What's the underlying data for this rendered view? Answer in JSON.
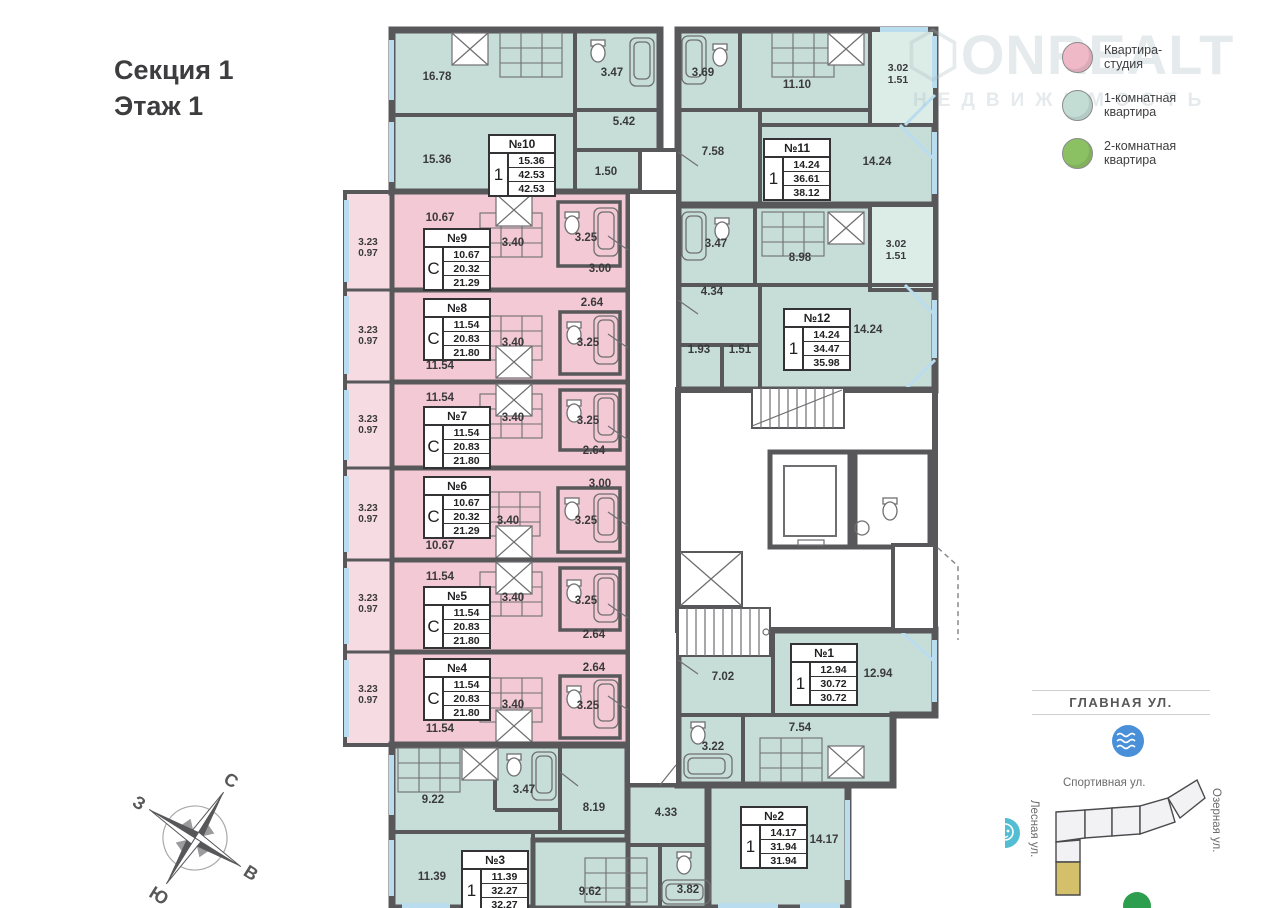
{
  "header": {
    "section": "Секция 1",
    "floor": "Этаж 1"
  },
  "watermark": {
    "brand": "ONREALT",
    "sub": "НЕДВИЖИМОСТЬ"
  },
  "legend": {
    "items": [
      {
        "label": "Квартира-студия",
        "color": "#efb9c8"
      },
      {
        "label": "1-комнатная квартира",
        "color": "#c3ddd5"
      },
      {
        "label": "2-комнатная квартира",
        "color": "#8cc163"
      }
    ]
  },
  "compass": {
    "north": "С",
    "south": "Ю",
    "west": "З",
    "east": "В"
  },
  "minimap": {
    "main_street": "ГЛАВНАЯ УЛ.",
    "sport_street": "Спортивная ул.",
    "lake_street": "Озерная ул.",
    "forest_street": "Лесная ул."
  },
  "colors": {
    "studio_fill": "#f2c9d4",
    "one_room_fill": "#c7ded8",
    "walls": "#58585a",
    "balcony_pink": "#f6dbe2",
    "balcony_teal": "#dcece7",
    "window": "#b9dcee",
    "minimap_section": "#d4c06b",
    "pool_icon": "#4a90d8",
    "kindergarten_icon": "#53bdd3",
    "park_icon": "#2d9e4e"
  },
  "apartments": {
    "a1": {
      "no": "№1",
      "type": "1",
      "living": "12.94",
      "area": "30.72",
      "total": "30.72",
      "rooms": {
        "hall": "7.02",
        "room": "12.94",
        "bath": "3.22",
        "kitchen": "7.54"
      }
    },
    "a2": {
      "no": "№2",
      "type": "1",
      "living": "14.17",
      "area": "31.94",
      "total": "31.94",
      "rooms": {
        "hall": "4.33",
        "room": "14.17",
        "kitchen": "9.62",
        "bath": "3.82"
      }
    },
    "a3": {
      "no": "№3",
      "type": "1",
      "living": "11.39",
      "area": "32.27",
      "total": "32.27",
      "rooms": {
        "r1": "9.22",
        "bath": "3.47",
        "hall": "8.19",
        "room": "11.39"
      }
    },
    "a4": {
      "no": "№4",
      "type": "С",
      "living": "11.54",
      "area": "20.83",
      "total": "21.80",
      "rooms": {
        "main": "11.54",
        "kitchen": "3.40",
        "bath": "3.25",
        "hall": "2.64"
      },
      "balcony": {
        "a": "3.23",
        "b": "0.97"
      }
    },
    "a5": {
      "no": "№5",
      "type": "С",
      "living": "11.54",
      "area": "20.83",
      "total": "21.80",
      "rooms": {
        "main": "11.54",
        "kitchen": "3.40",
        "bath": "3.25",
        "hall": "2.64"
      },
      "balcony": {
        "a": "3.23",
        "b": "0.97"
      }
    },
    "a6": {
      "no": "№6",
      "type": "С",
      "living": "10.67",
      "area": "20.32",
      "total": "21.29",
      "rooms": {
        "main": "10.67",
        "kitchen": "3.40",
        "bath": "3.25",
        "hall": "3.00"
      },
      "balcony": {
        "a": "3.23",
        "b": "0.97"
      }
    },
    "a7": {
      "no": "№7",
      "type": "С",
      "living": "11.54",
      "area": "20.83",
      "total": "21.80",
      "rooms": {
        "main": "11.54",
        "kitchen": "3.40",
        "bath": "3.25",
        "hall": "2.64"
      },
      "balcony": {
        "a": "3.23",
        "b": "0.97"
      }
    },
    "a8": {
      "no": "№8",
      "type": "С",
      "living": "11.54",
      "area": "20.83",
      "total": "21.80",
      "rooms": {
        "main": "11.54",
        "kitchen": "3.40",
        "bath": "3.25",
        "hall": "2.64"
      },
      "balcony": {
        "a": "3.23",
        "b": "0.97"
      }
    },
    "a9": {
      "no": "№9",
      "type": "С",
      "living": "10.67",
      "area": "20.32",
      "total": "21.29",
      "rooms": {
        "main": "10.67",
        "kitchen": "3.40",
        "bath": "3.25",
        "hall": "3.00"
      },
      "balcony": {
        "a": "3.23",
        "b": "0.97"
      }
    },
    "a10": {
      "no": "№10",
      "type": "1",
      "living": "15.36",
      "area": "42.53",
      "total": "42.53",
      "rooms": {
        "r1": "16.78",
        "r2": "15.36",
        "bath": "3.47",
        "hall": "5.42",
        "entry": "1.50"
      }
    },
    "a11": {
      "no": "№11",
      "type": "1",
      "living": "14.24",
      "area": "36.61",
      "total": "38.12",
      "rooms": {
        "bath": "3.69",
        "kitchen": "11.10",
        "hall": "7.58",
        "room": "14.24",
        "balc1": "3.02",
        "balc2": "1.51"
      }
    },
    "a12": {
      "no": "№12",
      "type": "1",
      "living": "14.24",
      "area": "34.47",
      "total": "35.98",
      "rooms": {
        "bath": "3.47",
        "kitchen": "8.98",
        "hall": "4.34",
        "c1": "1.93",
        "c2": "1.51",
        "room": "14.24",
        "balc1": "3.02",
        "balc2": "1.51"
      }
    }
  }
}
